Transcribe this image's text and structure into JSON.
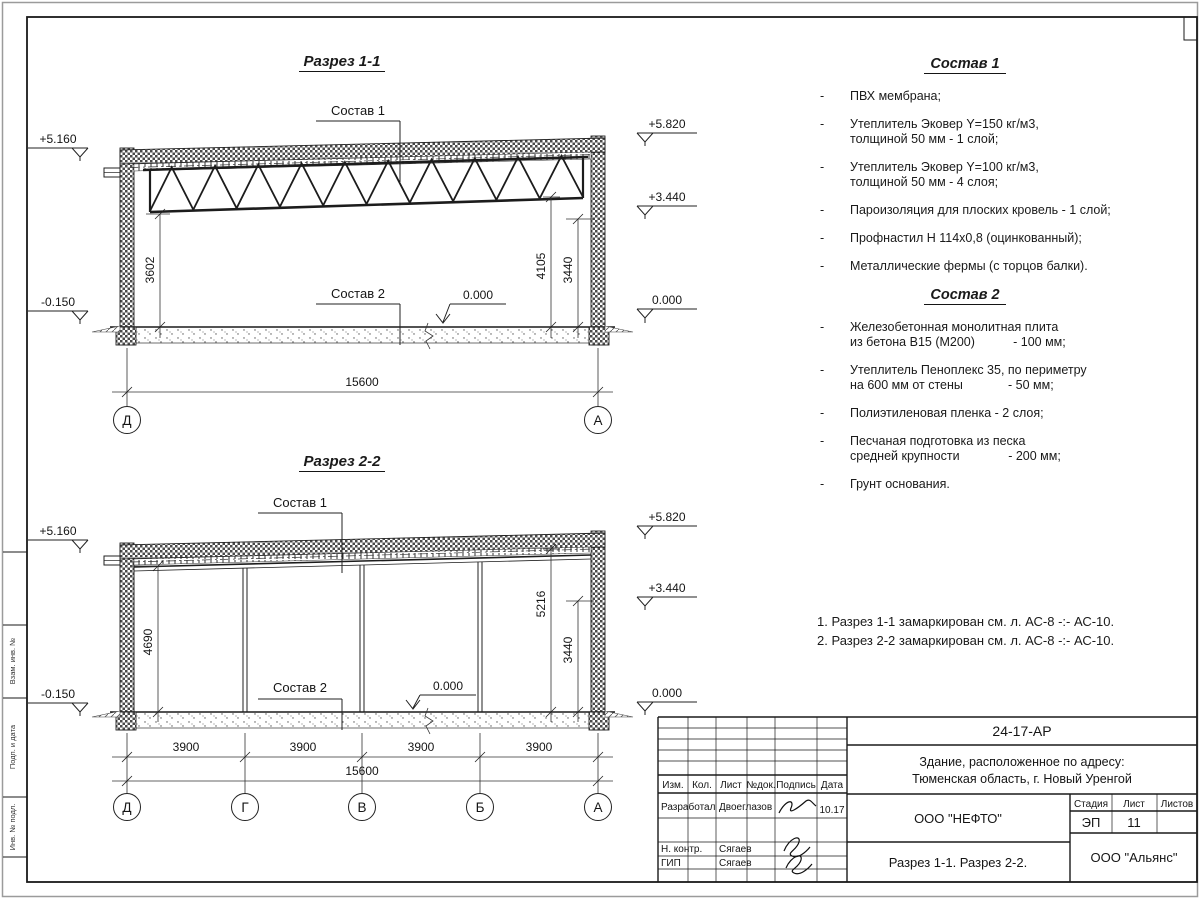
{
  "page": {
    "side_labels": [
      "Взам. инв. №",
      "Подп. и дата",
      "Инв. № подл."
    ]
  },
  "section1": {
    "title": "Разрез 1-1",
    "composition1_label": "Состав 1",
    "composition2_label": "Состав 2",
    "elev_left_top": "+5.160",
    "elev_left_bottom": "-0.150",
    "elev_right_top": "+5.820",
    "elev_right_mid": "+3.440",
    "elev_right_bottom": "0.000",
    "elev_floor": "0.000",
    "dim_left_height": "3602",
    "dim_right_height": "4105",
    "dim_right_height2": "3440",
    "dim_total": "15600",
    "axes": [
      "Д",
      "А"
    ]
  },
  "section2": {
    "title": "Разрез 2-2",
    "composition1_label": "Состав 1",
    "composition2_label": "Состав 2",
    "elev_left_top": "+5.160",
    "elev_left_bottom": "-0.150",
    "elev_right_top": "+5.820",
    "elev_right_mid": "+3.440",
    "elev_right_bottom": "0.000",
    "elev_floor": "0.000",
    "dim_left_height": "4690",
    "dim_right_height": "5216",
    "dim_right_height2": "3440",
    "spans": [
      "3900",
      "3900",
      "3900",
      "3900"
    ],
    "dim_total": "15600",
    "axes": [
      "Д",
      "Г",
      "В",
      "Б",
      "А"
    ]
  },
  "composition1": {
    "title": "Состав 1",
    "items": [
      {
        "text": "ПВХ мембрана;"
      },
      {
        "text": "Утеплитель Эковер Y=150 кг/м3,\nтолщиной 50 мм - 1 слой;"
      },
      {
        "text": "Утеплитель Эковер Y=100 кг/м3,\nтолщиной 50 мм - 4 слоя;"
      },
      {
        "text": "Пароизоляция для плоских кровель - 1 слой;"
      },
      {
        "text": "Профнастил Н 114х0,8 (оцинкованный);"
      },
      {
        "text": "Металлические фермы (с торцов балки)."
      }
    ]
  },
  "composition2": {
    "title": "Состав 2",
    "items": [
      {
        "text": "Железобетонная  монолитная плита\nиз бетона В15 (М200)           - 100 мм;"
      },
      {
        "text": "Утеплитель Пеноплекс 35, по периметру\nна 600 мм от стены             - 50 мм;"
      },
      {
        "text": "Полиэтиленовая пленка - 2 слоя;"
      },
      {
        "text": "Песчаная подготовка из песка\nсредней крупности              - 200 мм;"
      },
      {
        "text": "Грунт основания."
      }
    ]
  },
  "notes": {
    "line1": "1. Разрез 1-1 замаркирован см. л. АС-8 -:- АС-10.",
    "line2": "2. Разрез 2-2 замаркирован см. л. АС-8 -:- АС-10."
  },
  "titleblock": {
    "doc_code": "24-17-АР",
    "object_line1": "Здание, расположенное по адресу:",
    "object_line2": "Тюменская область, г. Новый Уренгой",
    "org": "ООО \"НЕФТО\"",
    "drawing_title": "Разрез 1-1. Разрез 2-2.",
    "contractor": "ООО \"Альянс\"",
    "col_izm": "Изм.",
    "col_kol": "Кол.",
    "col_list": "Лист",
    "col_ndoc": "№док.",
    "col_podpis": "Подпись",
    "col_data": "Дата",
    "stage_label": "Стадия",
    "sheet_label": "Лист",
    "sheets_label": "Листов",
    "stage": "ЭП",
    "sheet": "11",
    "sheets": "",
    "row1_role": "Разработал",
    "row1_name": "Двоеглазов",
    "row1_date": "10.17",
    "row2_role": "Н. контр.",
    "row2_name": "Сягаев",
    "row3_role": "ГИП",
    "row3_name": "Сягаев"
  }
}
